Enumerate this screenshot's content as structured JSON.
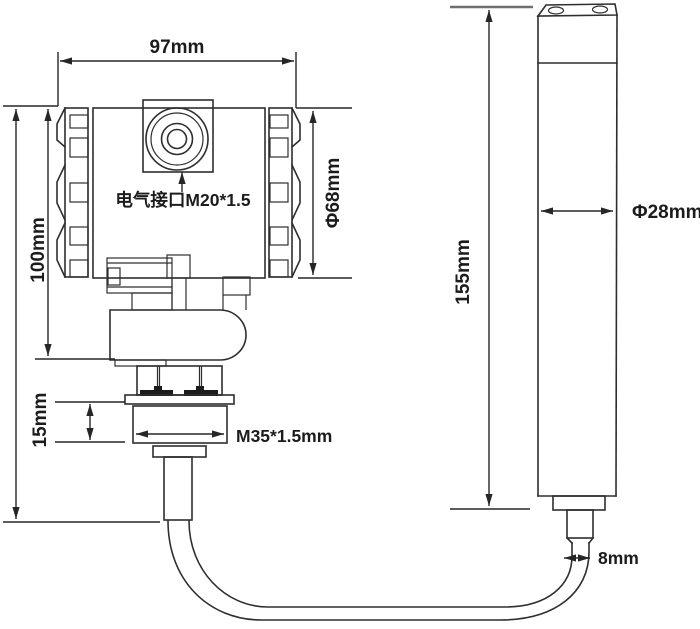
{
  "drawing": {
    "background": "#ffffff",
    "line_color": "#2e2e2e",
    "text_color": "#1c1c1c",
    "transmitter": {
      "width": "97mm",
      "height": "100mm",
      "cap_diameter": "Φ68mm",
      "electrical_port": "电气接口M20*1.5",
      "thread_section_height": "15mm",
      "mounting_thread": "M35*1.5mm"
    },
    "probe": {
      "height": "155mm",
      "diameter": "Φ28mm",
      "cable_diameter": "8mm"
    }
  }
}
